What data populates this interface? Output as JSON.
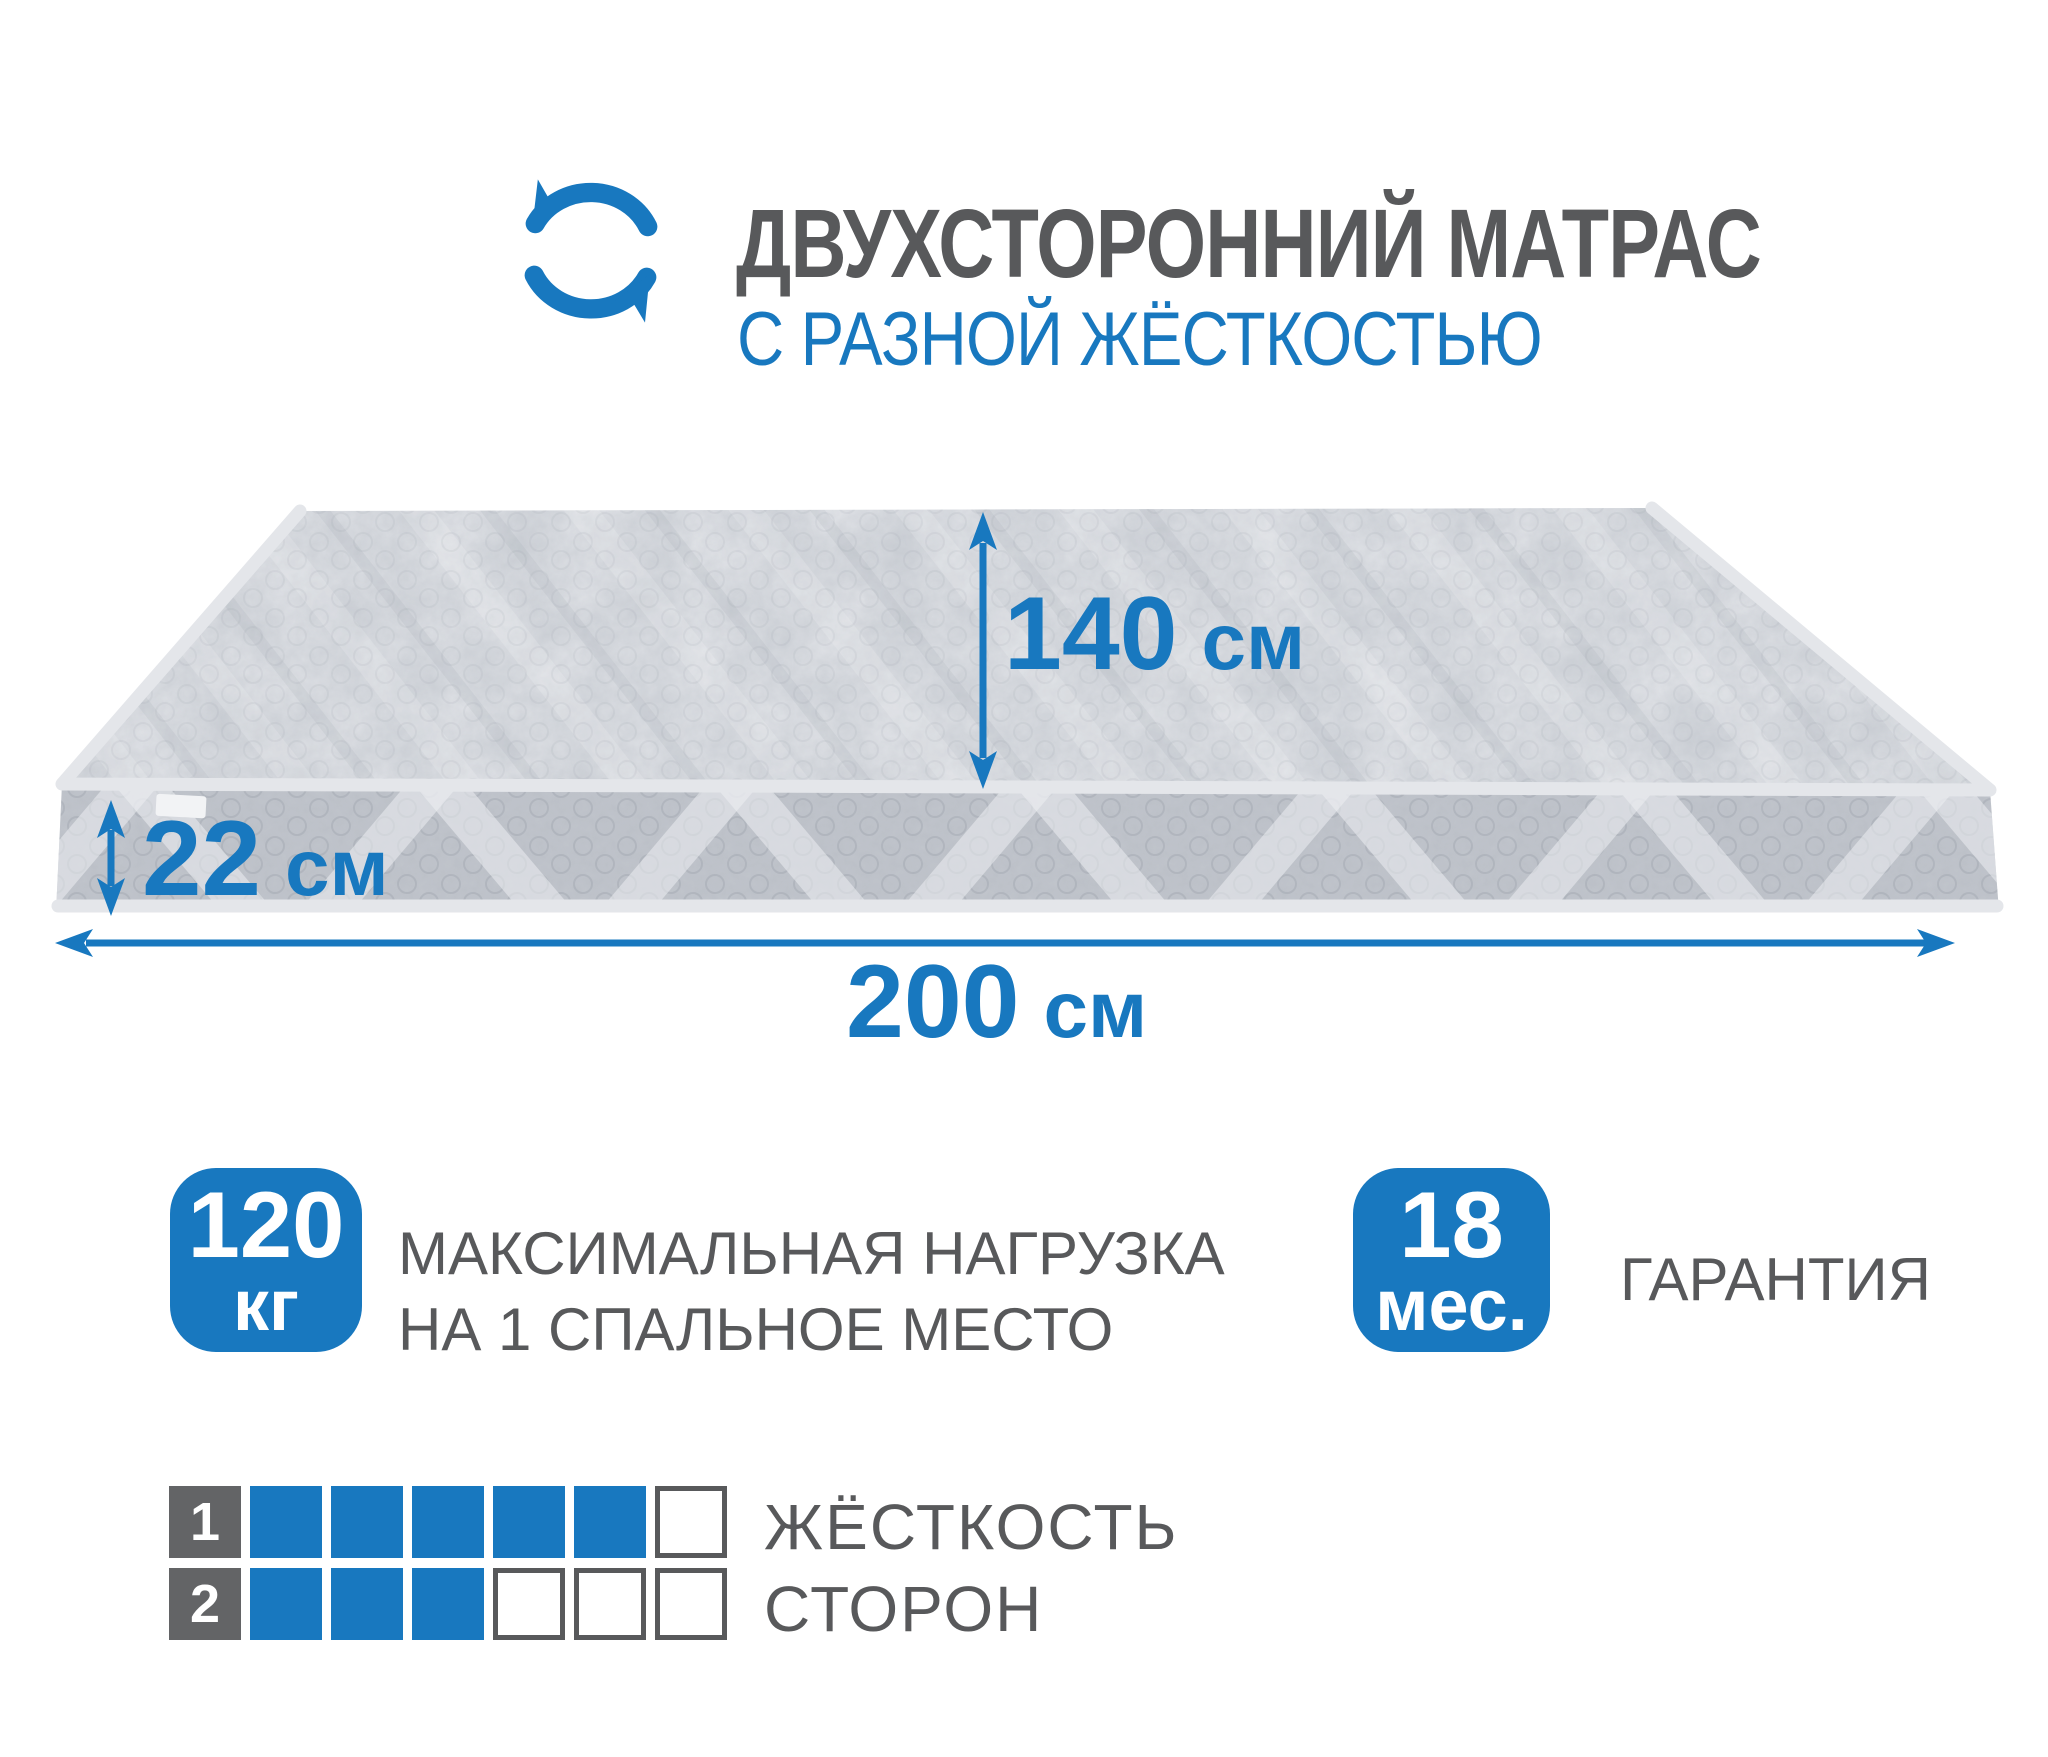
{
  "header": {
    "icon": "rotation-arrows-icon",
    "title": "ДВУХСТОРОННИЙ МАТРАС",
    "subtitle": "С РАЗНОЙ ЖЁСТКОСТЬЮ"
  },
  "dimensions": {
    "width": {
      "value": "140",
      "unit": "см"
    },
    "height": {
      "value": "22",
      "unit": "см"
    },
    "length": {
      "value": "200",
      "unit": "см"
    }
  },
  "badges": {
    "load": {
      "value": "120",
      "unit": "кг",
      "line1": "МАКСИМАЛЬНАЯ НАГРУЗКА",
      "line2": "НА 1 СПАЛЬНОЕ МЕСТО"
    },
    "warranty": {
      "value": "18",
      "unit": "мес.",
      "label": "ГАРАНТИЯ"
    }
  },
  "firmness": {
    "title_line1": "ЖЁСТКОСТЬ",
    "title_line2": "СТОРОН",
    "scale_max": 6,
    "rows": [
      {
        "side": "1",
        "filled": 5
      },
      {
        "side": "2",
        "filled": 3
      }
    ]
  },
  "colors": {
    "accent": "#1878bf",
    "text_dark": "#58595b",
    "label_dark": "#636466",
    "cell_border": "#58595b",
    "mattress_top": "#cbcfd5",
    "mattress_side": "#c1c5cc",
    "piping": "#e4e6ea"
  }
}
